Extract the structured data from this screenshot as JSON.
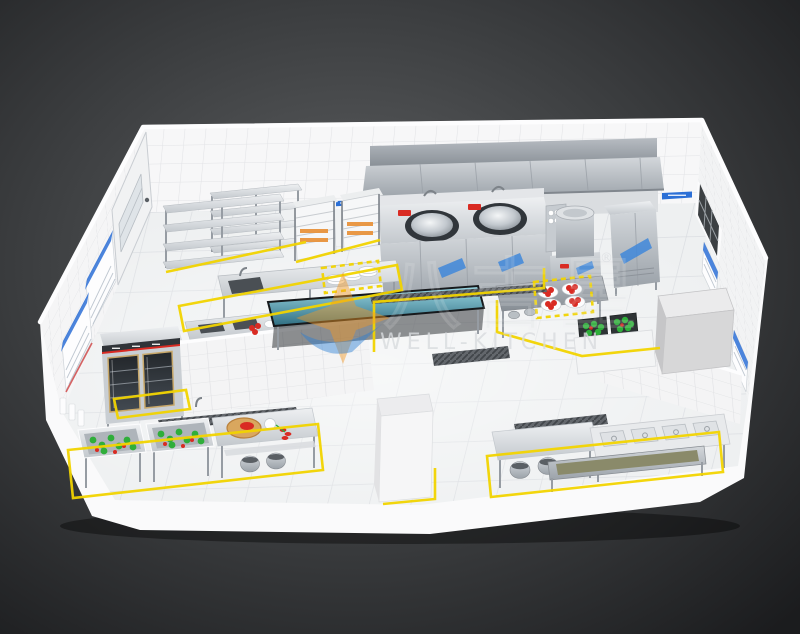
{
  "watermark": {
    "brand_cn": "八吉星",
    "brand_en": "WELL-KITCHEN",
    "registered": "®"
  },
  "colors": {
    "background_center": "#5f6163",
    "background_edge": "#1e1f21",
    "wall_tile": "#f7f7f8",
    "floor_tile": "#eef0f1",
    "stainless_light": "#d3d7db",
    "stainless_dark": "#9ba2a9",
    "yellow_tape": "#f2d400",
    "label_blue": "#2b6fd6",
    "accent_red": "#d92b23",
    "veg_green": "#2fae3a",
    "cutting_board_wood": "#d9a75e",
    "teal_table": "#4f9db1",
    "logo_orange": "#f59a23",
    "logo_blue": "#2a7fd4"
  },
  "scene": {
    "kind": "3d-isometric-commercial-kitchen-floor-plan",
    "areas": [
      "storage-shelving-area",
      "steamer-cabinet-area",
      "exhaust-hood-and-wok-cooking-line",
      "soup-stockpot-station",
      "sterilizer-cabinet",
      "prep-sink-tables-with-plates",
      "teal-top-work-table",
      "double-glass-door-refrigerator",
      "vegetable-washing-line",
      "cutting-prep-table",
      "center-island-with-tomato-plates",
      "vegetable-crates",
      "large-storage-cube",
      "service-counter-with-wells",
      "yellow-floor-zone-markings",
      "blue-wall-signs",
      "left-wall-door",
      "right-wall-window"
    ]
  }
}
